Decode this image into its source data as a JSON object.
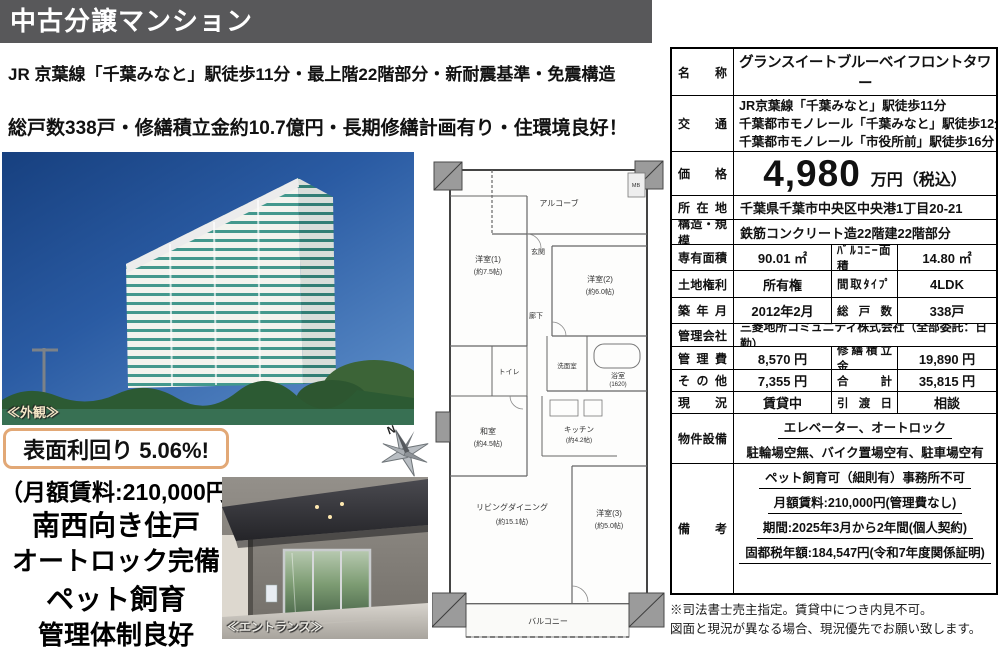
{
  "header": {
    "badge": "中古分譲マンション"
  },
  "headlines": {
    "line1": "JR 京葉線「千葉みなと」駅徒歩11分・最上階22階部分・新耐震基準・免震構造",
    "line2": "総戸数338戸・修繕積立金約10.7億円・長期修繕計画有り・住環境良好！"
  },
  "photos": {
    "exterior_caption": "≪外観≫",
    "entrance_caption": "≪エントランス≫"
  },
  "promo": {
    "yield_text": "表面利回り  5.06%!",
    "rent_note": "（月額賃料:210,000円）",
    "feature1": "南西向き住戸",
    "feature2": "オートロック完備",
    "feature3": "ペット飼育",
    "feature4": "管理体制良好"
  },
  "compass": {
    "north": "N"
  },
  "floorplan": {
    "alcove": "アルコーブ",
    "mb": "MB",
    "room1": "洋室(1)",
    "room1_size": "(約7.5帖)",
    "genkan": "玄関",
    "room2": "洋室(2)",
    "room2_size": "(約6.0帖)",
    "hall": "廊下",
    "toilet": "トイレ",
    "wash": "洗面室",
    "bath": "浴室",
    "bath_size": "(1620)",
    "washitsu": "和室",
    "washitsu_size": "(約4.5帖)",
    "kitchen": "キッチン",
    "kitchen_size": "(約4.2帖)",
    "living": "リビングダイニング",
    "living_size": "(約15.1帖)",
    "room3": "洋室(3)",
    "room3_size": "(約5.0帖)",
    "balcony": "バルコニー"
  },
  "table": {
    "name": {
      "label": "名称",
      "value": "グランスイートブルーベイフロントタワー"
    },
    "access": {
      "label": "交通",
      "line1": "JR京葉線「千葉みなと」駅徒歩11分",
      "line2": "千葉都市モノレール「千葉みなと」駅徒歩12分",
      "line3": "千葉都市モノレール「市役所前」駅徒歩16分"
    },
    "price": {
      "label": "価格",
      "value": "4,980",
      "unit": "万円（税込）"
    },
    "address": {
      "label": "所在地",
      "value": "千葉県千葉市中央区中央港1丁目20-21"
    },
    "structure": {
      "label": "構造・規模",
      "value": "鉄筋コンクリート造22階建22階部分"
    },
    "area": {
      "label": "専有面積",
      "value": "90.01 ㎡",
      "label2": "ﾊﾞﾙｺﾆｰ面積",
      "value2": "14.80 ㎡"
    },
    "land": {
      "label": "土地権利",
      "value": "所有権",
      "label2": "間取ﾀｲﾌﾟ",
      "value2": "4LDK"
    },
    "built": {
      "label": "築年月",
      "value": "2012年2月",
      "label2": "総戸数",
      "value2": "338戸"
    },
    "mgmt_co": {
      "label": "管理会社",
      "value": "三菱地所コミュニティ株式会社（全部委託：日勤）"
    },
    "mgmt_fee": {
      "label": "管理費",
      "value": "8,570 円",
      "label2": "修繕積立金",
      "value2": "19,890 円"
    },
    "other": {
      "label": "その他",
      "value": "7,355 円",
      "label2": "合計",
      "value2": "35,815 円"
    },
    "status": {
      "label": "現況",
      "value": "賃貸中",
      "label2": "引渡日",
      "value2": "相談"
    },
    "equipment": {
      "label": "物件設備",
      "line1": "エレベーター、オートロック",
      "line2": "駐輪場空無、バイク置場空有、駐車場空有"
    },
    "remarks": {
      "label": "備考",
      "line1": "ペット飼育可（細則有）事務所不可",
      "line2": "月額賃料:210,000円(管理費なし)",
      "line3": "期間:2025年3月から2年間(個人契約)",
      "line4": "固都税年額:184,547円(令和7年度関係証明)"
    }
  },
  "footnotes": {
    "line1": "※司法書士売主指定。賃貸中につき内見不可。",
    "line2": "図面と現況が異なる場合、現況優先でお願い致します。"
  },
  "colors": {
    "header_bg": "#58585a",
    "accent_border": "#e2a876",
    "price_text": "#000000"
  }
}
